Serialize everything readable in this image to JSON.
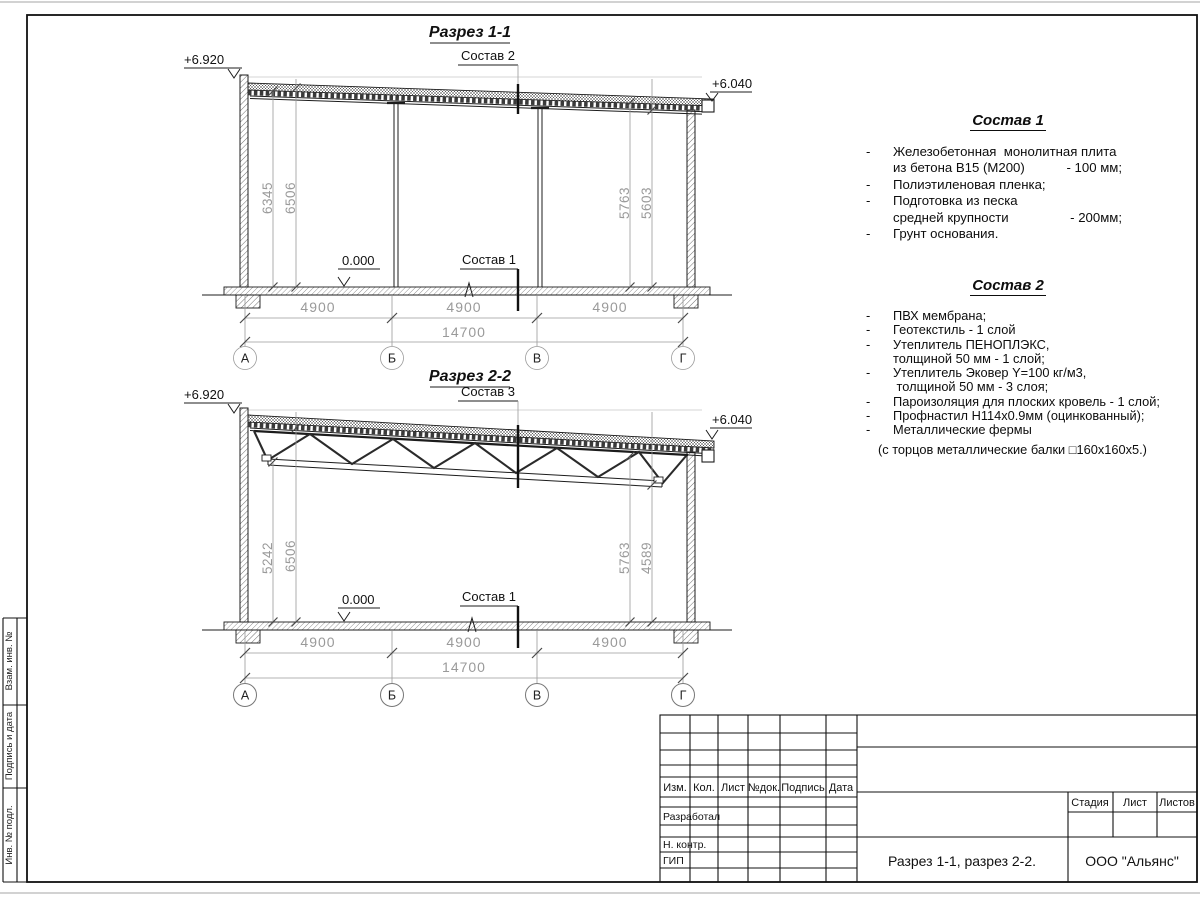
{
  "page": {
    "margin_labels": [
      "Взам. инв. №",
      "Подпись и дата",
      "Инв. № подл."
    ]
  },
  "sections": [
    {
      "title": "Разрез 1-1",
      "roof_label": "Состав 2",
      "floor_label": "Состав 1",
      "level_left": "+6.920",
      "level_right": "+6.040",
      "level_zero": "0.000",
      "dim_left_outer": "6345",
      "dim_left_inner": "6506",
      "dim_right_inner": "5763",
      "dim_right_outer": "5603",
      "span1": "4900",
      "span2": "4900",
      "span3": "4900",
      "total": "14700",
      "axis1": "А",
      "axis2": "Б",
      "axis3": "В",
      "axis4": "Г"
    },
    {
      "title": "Разрез 2-2",
      "roof_label": "Состав 3",
      "floor_label": "Состав 1",
      "level_left": "+6.920",
      "level_right": "+6.040",
      "level_zero": "0.000",
      "dim_left_outer": "5242",
      "dim_left_inner": "6506",
      "dim_right_inner": "5763",
      "dim_right_outer": "4589",
      "span1": "4900",
      "span2": "4900",
      "span3": "4900",
      "total": "14700",
      "axis1": "А",
      "axis2": "Б",
      "axis3": "В",
      "axis4": "Г"
    }
  ],
  "comp1": {
    "title": "Состав 1",
    "lines": [
      {
        "d": "-",
        "t": "Железобетонная  монолитная плита",
        "v": ""
      },
      {
        "d": "",
        "t": "из бетона В15 (М200)",
        "v": "- 100 мм;"
      },
      {
        "d": "-",
        "t": "Полиэтиленовая пленка;",
        "v": ""
      },
      {
        "d": "-",
        "t": "Подготовка из песка",
        "v": ""
      },
      {
        "d": "",
        "t": "средней крупности",
        "v": "- 200мм;"
      },
      {
        "d": "-",
        "t": "Грунт основания.",
        "v": ""
      }
    ]
  },
  "comp2": {
    "title": "Состав 2",
    "lines": [
      {
        "d": "-",
        "t": "ПВХ мембрана;"
      },
      {
        "d": "-",
        "t": "Геотекстиль - 1 слой"
      },
      {
        "d": "-",
        "t": "Утеплитель ПЕНОПЛЭКС,"
      },
      {
        "d": "",
        "t": "толщиной 50 мм - 1 слой;"
      },
      {
        "d": "-",
        "t": "Утеплитель Эковер Y=100 кг/м3,"
      },
      {
        "d": "",
        "t": " толщиной 50 мм - 3 слоя;"
      },
      {
        "d": "-",
        "t": "Пароизоляция для плоских кровель - 1 слой;"
      },
      {
        "d": "-",
        "t": "Профнастил Н114х0.9мм (оцинкованный);"
      },
      {
        "d": "-",
        "t": "Металлические фермы"
      }
    ],
    "note": "(с торцов металлические балки □160х160х5.)"
  },
  "titleblock": {
    "col_labels": [
      "Изм.",
      "Кол.",
      "Лист",
      "№док.",
      "Подпись",
      "Дата"
    ],
    "row_labels": [
      "Разработал",
      "Н. контр.",
      "ГИП"
    ],
    "stage_label": "Стадия",
    "sheet_label": "Лист",
    "sheets_label": "Листов",
    "doc_title": "Разрез 1-1, разрез 2-2.",
    "company": "ООО \"Альянс\""
  }
}
